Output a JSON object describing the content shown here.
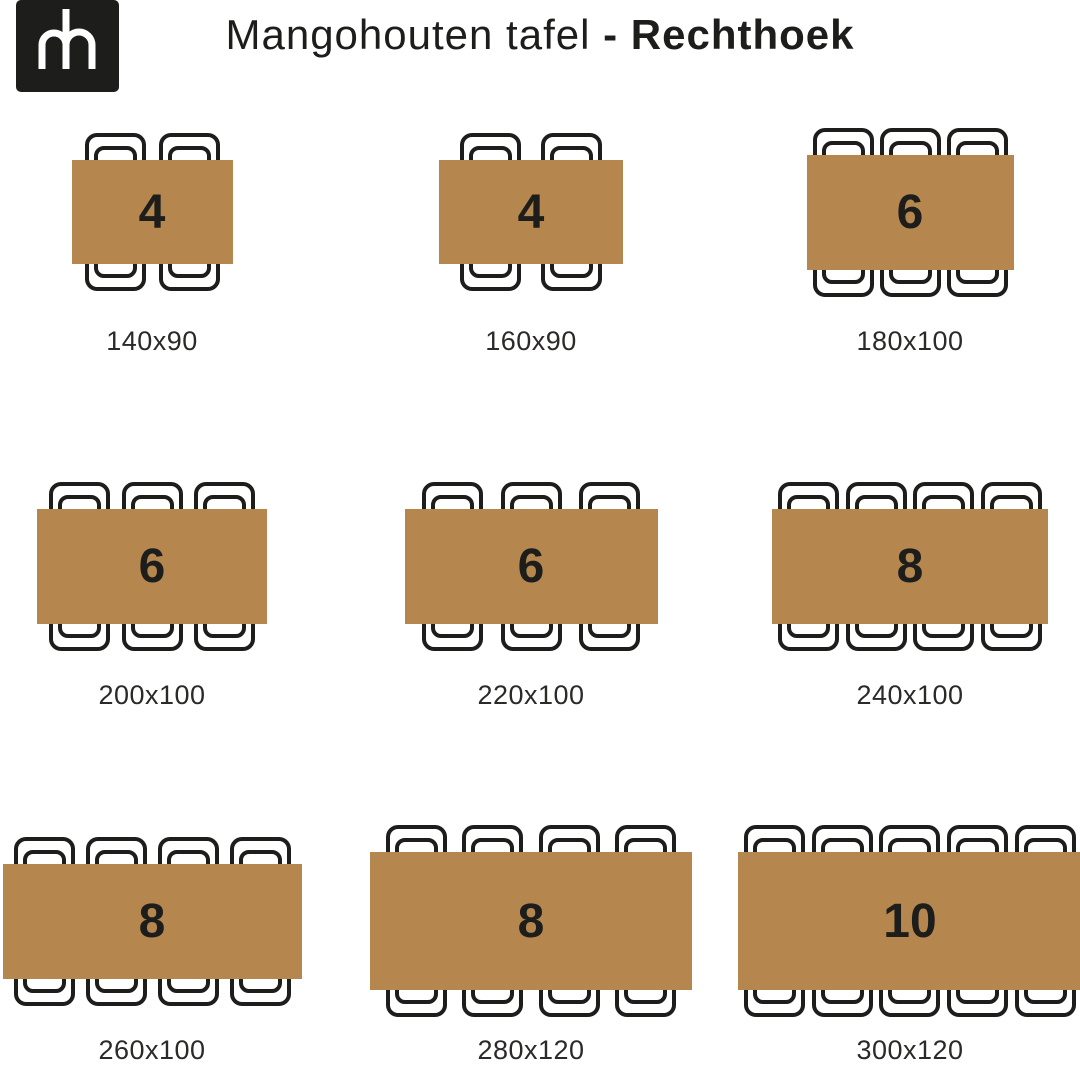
{
  "header": {
    "logo": {
      "monogram": "mh"
    },
    "title": {
      "regular": "Mangohouten tafel",
      "bold": "- Rechthoek"
    }
  },
  "colors": {
    "background": "#FFFFFF",
    "table_fill": "#B5874F",
    "outline": "#1D1D1B",
    "dimension_text": "#2B2A28",
    "logo_foreground": "#FFFFFF"
  },
  "tables": [
    {
      "seats": "4",
      "size_label": "140x90",
      "width_cm": 140,
      "depth_cm": 90,
      "chairs_top": 2,
      "chairs_bottom": 2
    },
    {
      "seats": "4",
      "size_label": "160x90",
      "width_cm": 160,
      "depth_cm": 90,
      "chairs_top": 2,
      "chairs_bottom": 2
    },
    {
      "seats": "6",
      "size_label": "180x100",
      "width_cm": 180,
      "depth_cm": 100,
      "chairs_top": 3,
      "chairs_bottom": 3
    },
    {
      "seats": "6",
      "size_label": "200x100",
      "width_cm": 200,
      "depth_cm": 100,
      "chairs_top": 3,
      "chairs_bottom": 3
    },
    {
      "seats": "6",
      "size_label": "220x100",
      "width_cm": 220,
      "depth_cm": 100,
      "chairs_top": 3,
      "chairs_bottom": 3
    },
    {
      "seats": "8",
      "size_label": "240x100",
      "width_cm": 240,
      "depth_cm": 100,
      "chairs_top": 4,
      "chairs_bottom": 4
    },
    {
      "seats": "8",
      "size_label": "260x100",
      "width_cm": 260,
      "depth_cm": 100,
      "chairs_top": 4,
      "chairs_bottom": 4
    },
    {
      "seats": "8",
      "size_label": "280x120",
      "width_cm": 280,
      "depth_cm": 120,
      "chairs_top": 4,
      "chairs_bottom": 4
    },
    {
      "seats": "10",
      "size_label": "300x120",
      "width_cm": 300,
      "depth_cm": 120,
      "chairs_top": 5,
      "chairs_bottom": 5
    }
  ]
}
